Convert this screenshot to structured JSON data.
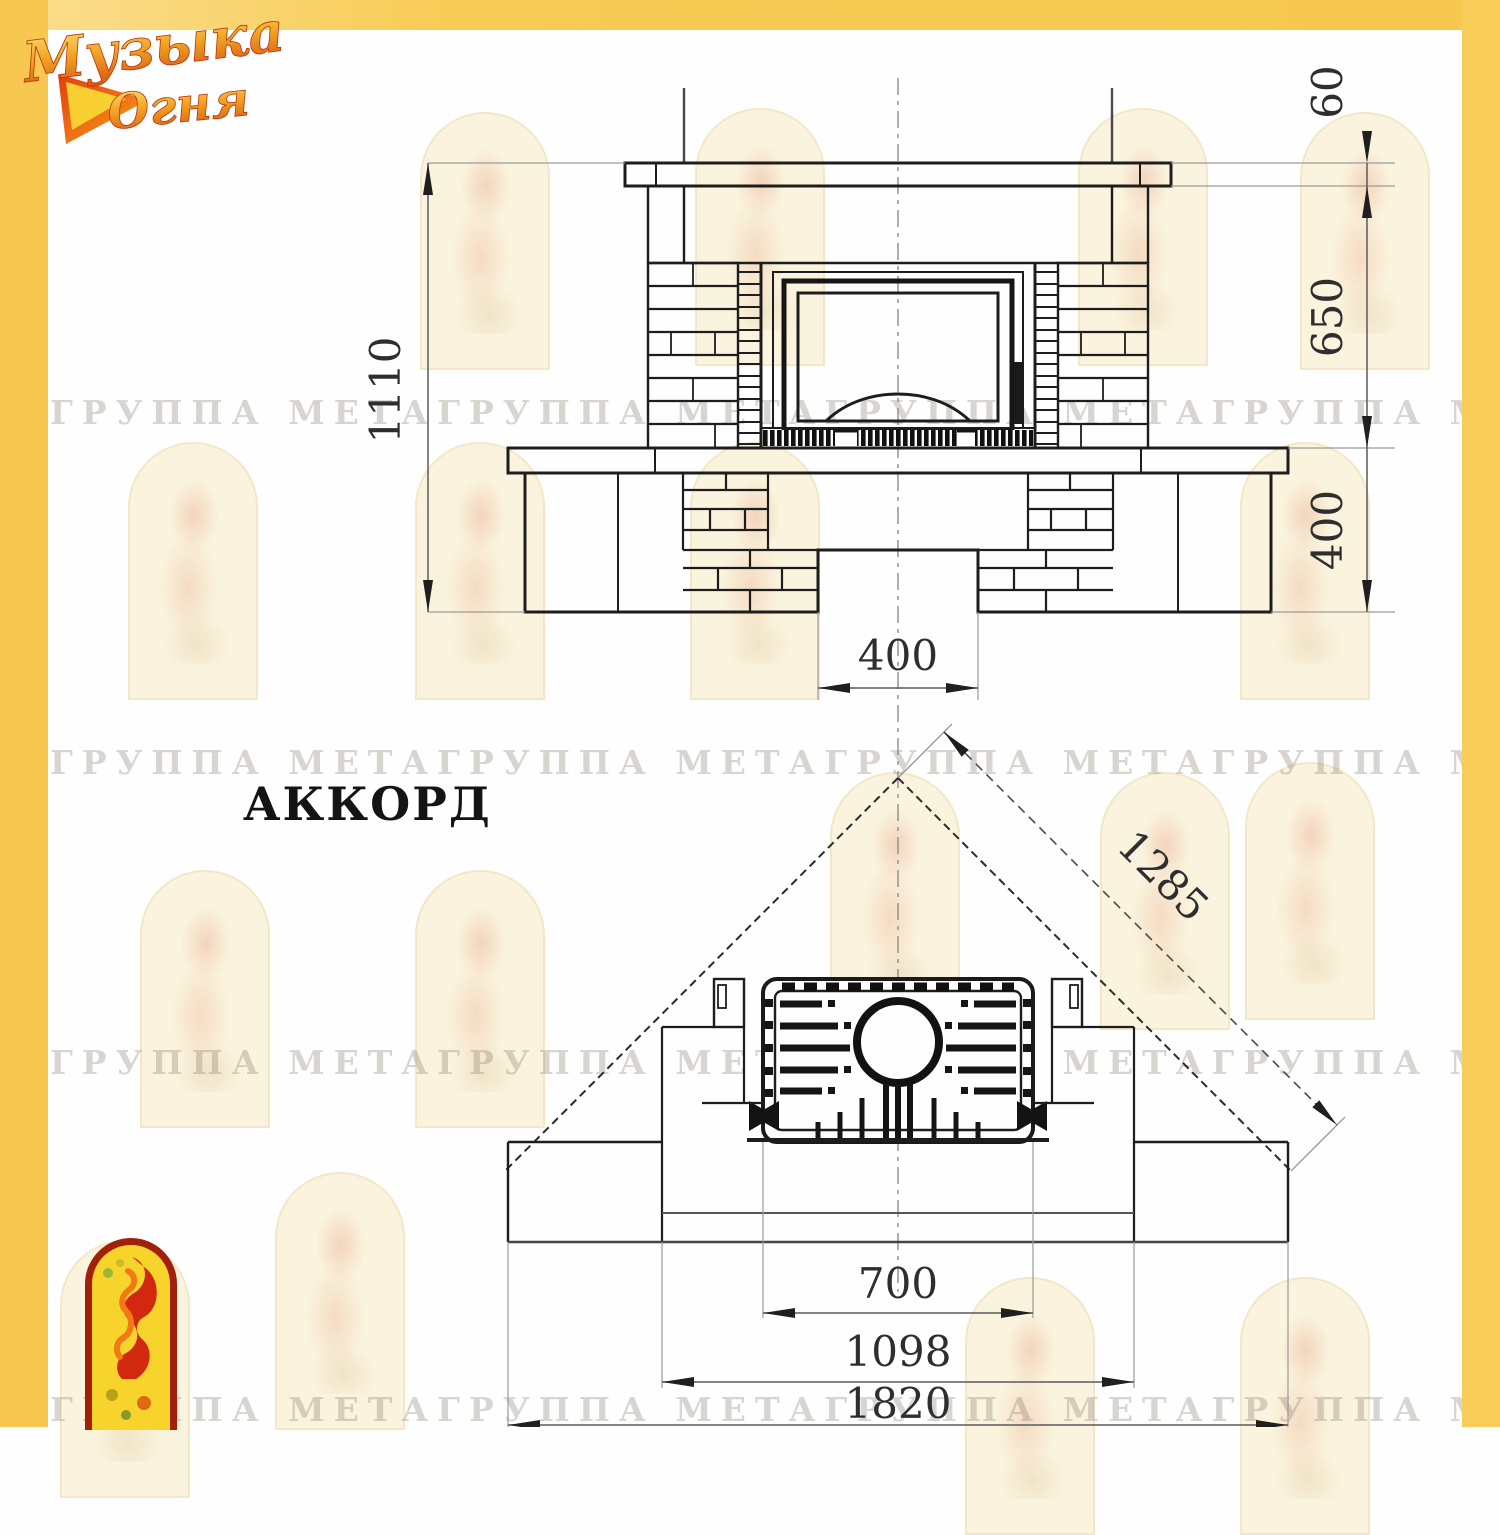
{
  "sheet": {
    "model_name": "АККОРД"
  },
  "brand": {
    "word1": "Музыка",
    "word2": "Огня"
  },
  "watermark": {
    "row_text": "ГРУППА МЕТАГРУППА МЕТАГРУППА МЕТАГРУППА МЕТАГРУППА МЕТА"
  },
  "front_view": {
    "dim_total_height": "1110",
    "dim_mantel_thickness": "60",
    "dim_opening_height": "650",
    "dim_base_height": "400",
    "dim_notch_width": "400"
  },
  "plan_view": {
    "dim_wall_diagonal": "1285",
    "dim_firebox_width": "700",
    "dim_bench_width": "1098",
    "dim_overall_width": "1820"
  },
  "colors": {
    "accent_yellow": "#f6c84f",
    "line": "#1d1d1d",
    "dim_text": "#2e2e2e"
  }
}
